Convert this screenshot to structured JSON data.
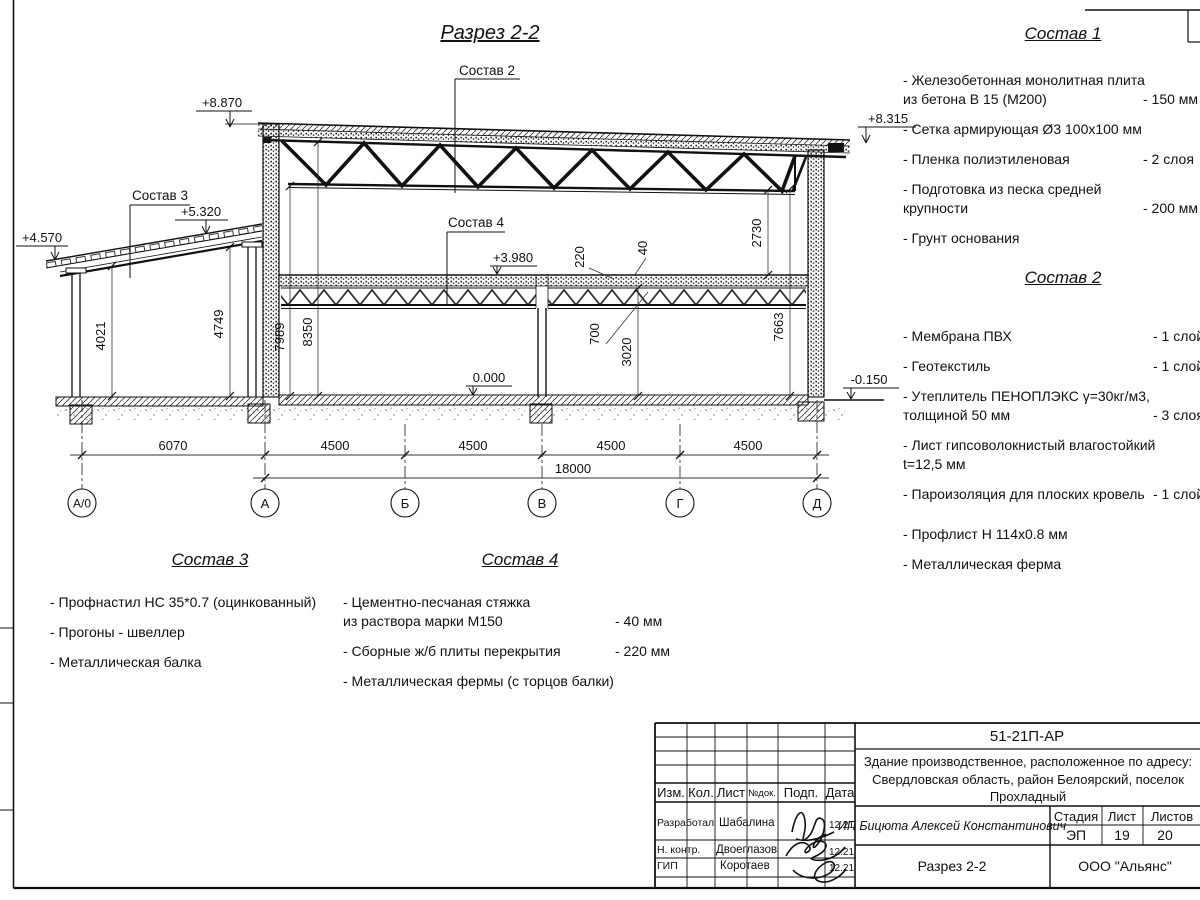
{
  "title": "Разрез 2-2",
  "labels": {
    "el_8870": "+8.870",
    "el_8315": "+8.315",
    "el_5320": "+5.320",
    "el_4570": "+4.570",
    "el_3980": "+3.980",
    "el_0000": "0.000",
    "el_m0150": "-0.150",
    "c2": "Состав 2",
    "c3": "Состав 3",
    "c4": "Состав 4",
    "d4021": "4021",
    "d4749": "4749",
    "d7989": "7989",
    "d8350": "8350",
    "d220": "220",
    "d40": "40",
    "d700": "700",
    "d3020": "3020",
    "d2730": "2730",
    "d7663": "7663",
    "d6070": "6070",
    "d4500a": "4500",
    "d4500b": "4500",
    "d4500c": "4500",
    "d4500d": "4500",
    "d18000": "18000",
    "ax0": "А/0",
    "ax1": "А",
    "ax2": "Б",
    "ax3": "В",
    "ax4": "Г",
    "ax5": "Д"
  },
  "lists": {
    "s1": {
      "title": "Состав 1",
      "items": [
        {
          "name": "- Железобетонная  монолитная плита\nиз бетона В 15 (М200)",
          "value": "- 150 мм"
        },
        {
          "name": "- Сетка армирующая Ø3 100х100 мм",
          "value": ""
        },
        {
          "name": "- Пленка полиэтиленовая",
          "value": "- 2 слоя"
        },
        {
          "name": "- Подготовка из песка средней\nкрупности",
          "value": "- 200 мм"
        },
        {
          "name": "- Грунт основания",
          "value": ""
        }
      ]
    },
    "s2": {
      "title": "Состав 2",
      "items": [
        {
          "name": "- Мембрана ПВХ",
          "value": "- 1 слой"
        },
        {
          "name": "- Геотекстиль",
          "value": "- 1 слой"
        },
        {
          "name": "- Утеплитель ПЕНОПЛЭКС γ=30кг/м3,\nтолщиной 50 мм",
          "value": "- 3 слоя"
        },
        {
          "name": "- Лист гипсоволокнистый влагостойкий\nt=12,5 мм",
          "value": ""
        },
        {
          "name": "- Пароизоляция для плоских кровель",
          "value": "- 1 слой"
        },
        {
          "name": "- Профлист Н 114х0.8 мм",
          "value": ""
        },
        {
          "name": "- Металлическая ферма",
          "value": ""
        }
      ]
    },
    "s3": {
      "title": "Состав 3",
      "items": [
        {
          "name": "- Профнастил НС 35*0.7 (оцинкованный)",
          "value": ""
        },
        {
          "name": "- Прогоны - швеллер",
          "value": ""
        },
        {
          "name": "- Металлическая балка",
          "value": ""
        }
      ]
    },
    "s4": {
      "title": "Состав 4",
      "items": [
        {
          "name": "- Цементно-песчаная стяжка\nиз раствора марки М150",
          "value": "- 40 мм"
        },
        {
          "name": "- Сборные ж/б плиты перекрытия",
          "value": "- 220 мм"
        },
        {
          "name": "- Металлическая фермы (с торцов балки)",
          "value": ""
        }
      ]
    }
  },
  "titleblock": {
    "doc_number": "51-21П-АР",
    "project": "Здание производственное, расположенное по адресу:\nСвердловская область, район Белоярский, поселок\nПрохладный",
    "client": "ИП Бицюта Алексей Константинович",
    "section_name": "Разрез 2-2",
    "company": "ООО \"Альянс\"",
    "stage_label": "Стадия",
    "sheet_label": "Лист",
    "sheets_label": "Листов",
    "stage": "ЭП",
    "sheet": "19",
    "sheets": "20",
    "col_izm": "Изм.",
    "col_kol": "Кол.",
    "col_list": "Лист",
    "col_ndok": "№док.",
    "col_podp": "Подп.",
    "col_data": "Дата",
    "row1_role": "Разработал",
    "row1_name": "Шабалина",
    "row1_date": "12.21",
    "row2_role": "Н. контр.",
    "row2_name": "Двоеглазов",
    "row2_date": "12.21",
    "row3_role": "ГИП",
    "row3_name": "Коротаев",
    "row3_date": "12.21"
  }
}
